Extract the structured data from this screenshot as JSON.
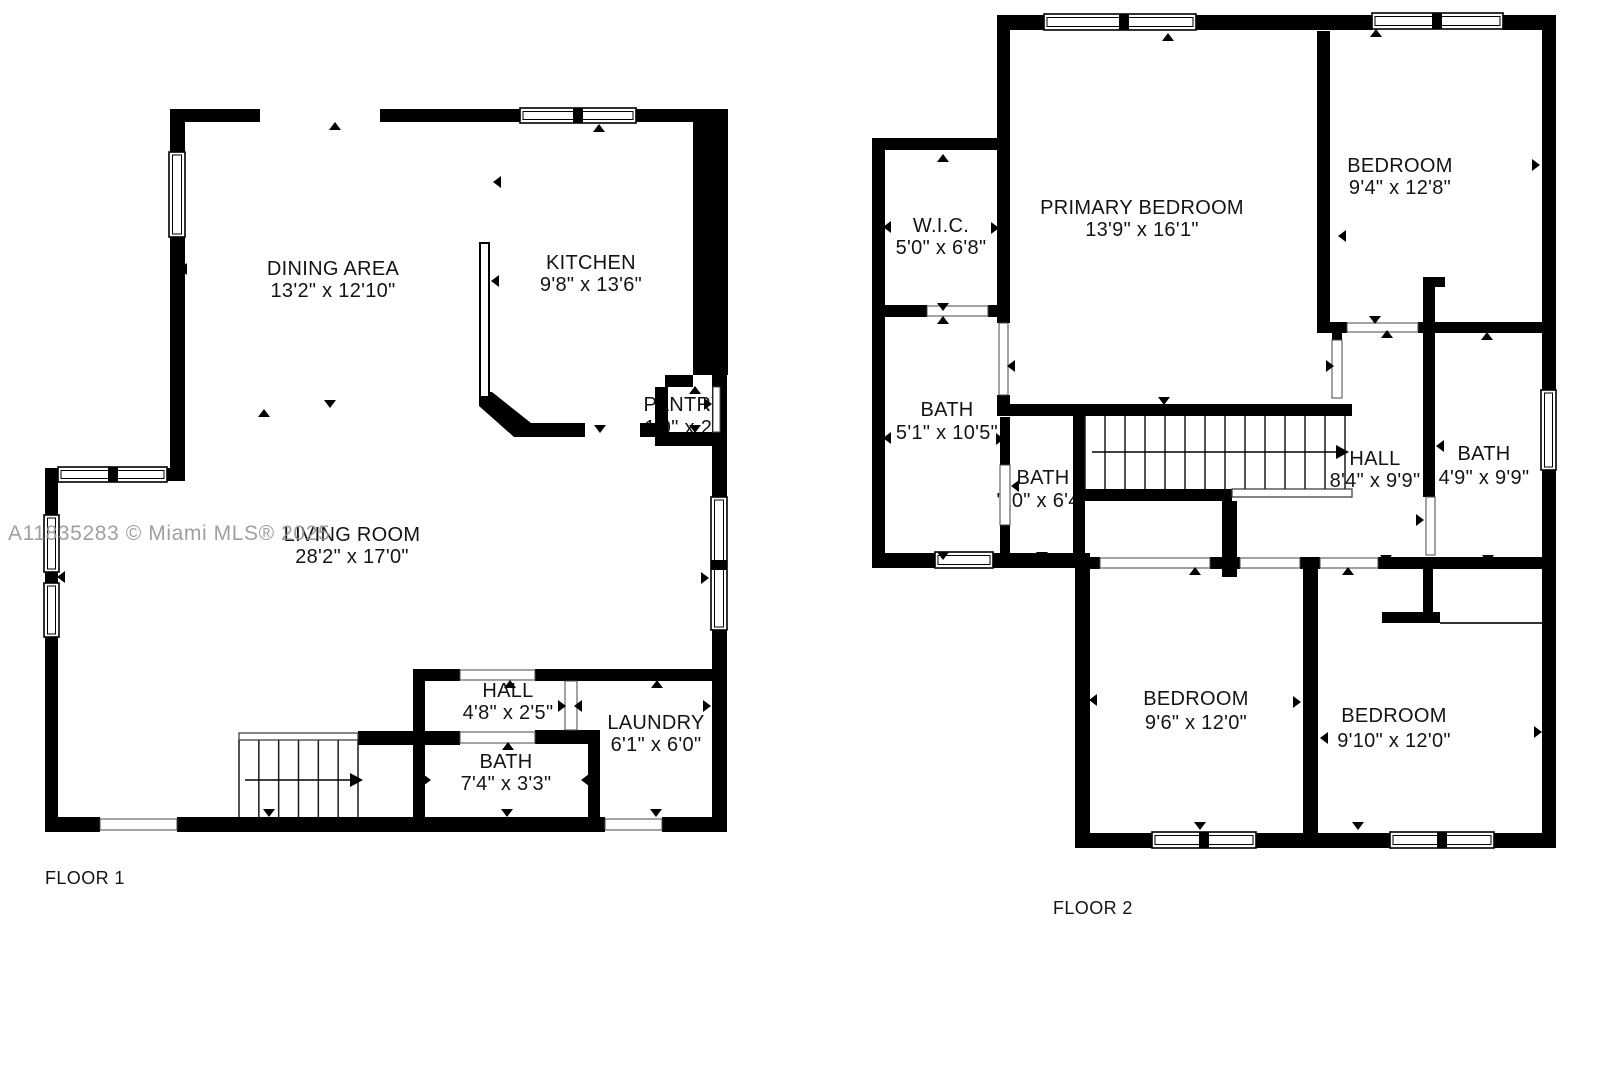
{
  "watermark": "A11835283 © Miami MLS® 2025",
  "floor1": {
    "label": "FLOOR 1",
    "rooms": {
      "dining": {
        "name": "DINING AREA",
        "dims": "13'2\" x 12'10\""
      },
      "kitchen": {
        "name": "KITCHEN",
        "dims": "9'8\" x 13'6\""
      },
      "pantry": {
        "name": "PANTRY",
        "dims": "1'9\" x 2'\""
      },
      "living": {
        "name": "LIVING ROOM",
        "dims": "28'2\" x 17'0\""
      },
      "hall": {
        "name": "HALL",
        "dims": "4'8\" x 2'5\""
      },
      "bath": {
        "name": "BATH",
        "dims": "7'4\" x 3'3\""
      },
      "laundry": {
        "name": "LAUNDRY",
        "dims": "6'1\" x 6'0\""
      }
    }
  },
  "floor2": {
    "label": "FLOOR 2",
    "rooms": {
      "wic": {
        "name": "W.I.C.",
        "dims": "5'0\" x 6'8\""
      },
      "primary": {
        "name": "PRIMARY BEDROOM",
        "dims": "13'9\" x 16'1\""
      },
      "bedroom_top_right": {
        "name": "BEDROOM",
        "dims": "9'4\" x 12'8\""
      },
      "bath_left": {
        "name": "BATH",
        "dims": "5'1\" x 10'5\""
      },
      "bath_small": {
        "name": "BATH",
        "dims": "'10\" x 6'4"
      },
      "hall": {
        "name": "HALL",
        "dims": "8'4\" x 9'9\""
      },
      "bath_right": {
        "name": "BATH",
        "dims": "4'9\" x 9'9\""
      },
      "bedroom_bottom_left": {
        "name": "BEDROOM",
        "dims": "9'6\" x 12'0\""
      },
      "bedroom_bottom_right": {
        "name": "BEDROOM",
        "dims": "9'10\" x 12'0\""
      }
    }
  }
}
